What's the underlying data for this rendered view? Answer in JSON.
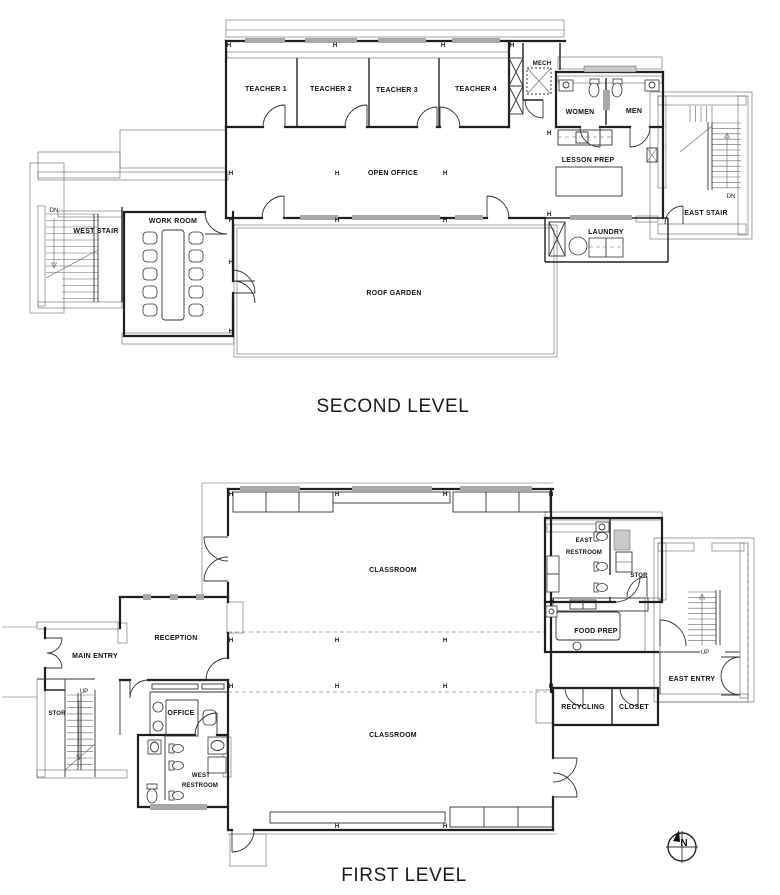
{
  "colors": {
    "line": "#1f1f1f",
    "wall_hatch": "#555555",
    "background": "#ffffff"
  },
  "second_level": {
    "title": "SECOND LEVEL",
    "rooms": {
      "teacher_1": "TEACHER 1",
      "teacher_2": "TEACHER 2",
      "teacher_3": "TEACHER 3",
      "teacher_4": "TEACHER 4",
      "mech": "MECH",
      "women": "WOMEN",
      "men": "MEN",
      "lesson_prep": "LESSON PREP",
      "open_office": "OPEN OFFICE",
      "east_stair": "EAST STAIR",
      "laundry": "LAUNDRY",
      "west_stair": "WEST STAIR",
      "work_room": "WORK ROOM",
      "roof_garden": "ROOF GARDEN"
    }
  },
  "first_level": {
    "title": "FIRST LEVEL",
    "rooms": {
      "classroom_north": "CLASSROOM",
      "classroom_south": "CLASSROOM",
      "east_restroom_line1": "EAST",
      "east_restroom_line2": "RESTROOM",
      "stor_east": "STOR",
      "food_prep": "FOOD PREP",
      "east_entry": "EAST ENTRY",
      "recycling": "RECYCLING",
      "closet": "CLOSET",
      "reception": "RECEPTION",
      "main_entry": "MAIN ENTRY",
      "stor_west": "STOR",
      "office": "OFFICE",
      "west_restroom_line1": "WEST",
      "west_restroom_line2": "RESTROOM"
    }
  },
  "markers": {
    "h": "H",
    "dn": "DN",
    "up": "UP",
    "north": "N"
  }
}
